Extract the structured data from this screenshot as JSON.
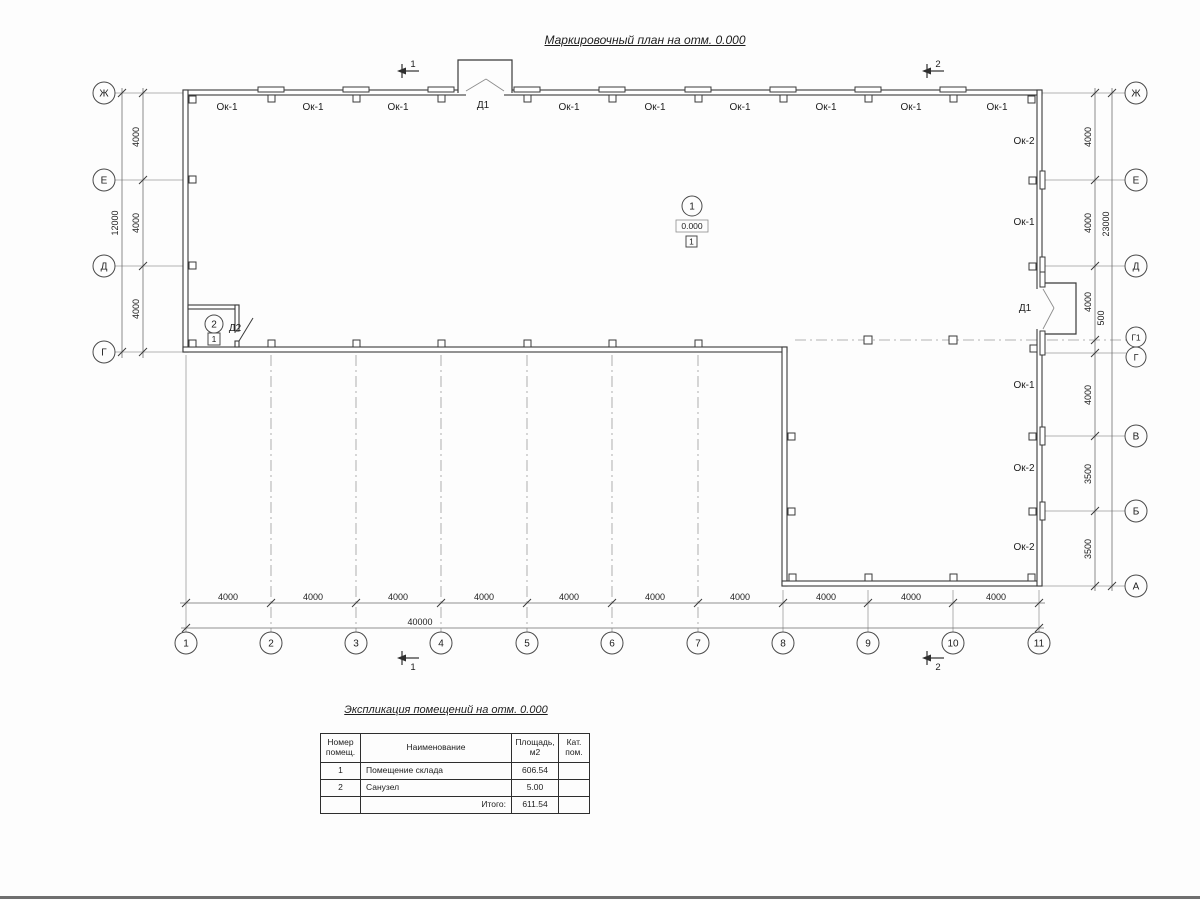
{
  "page": {
    "title": "Маркировочный план на отм. 0.000"
  },
  "plan": {
    "axes": {
      "left": [
        "Ж",
        "Е",
        "Д",
        "Г"
      ],
      "right": [
        "Ж",
        "Е",
        "Д",
        "Г1",
        "Г",
        "В",
        "Б",
        "А"
      ],
      "bottom": [
        "1",
        "2",
        "3",
        "4",
        "5",
        "6",
        "7",
        "8",
        "9",
        "10",
        "11"
      ]
    },
    "dimensions": {
      "left_segments": [
        "4000",
        "4000",
        "4000"
      ],
      "left_total": "12000",
      "right_segments": [
        "4000",
        "4000",
        "4000",
        "500",
        "4000",
        "3500",
        "3500"
      ],
      "right_total": "23000",
      "bottom_segments": [
        "4000",
        "4000",
        "4000",
        "4000",
        "4000",
        "4000",
        "4000",
        "4000",
        "4000",
        "4000"
      ],
      "bottom_total": "40000"
    },
    "windows": {
      "top": [
        "Ок-1",
        "Ок-1",
        "Ок-1",
        "Ок-1",
        "Ок-1",
        "Ок-1",
        "Ок-1",
        "Ок-1",
        "Ок-1"
      ],
      "right": [
        "Ок-2",
        "Ок-1",
        "Ок-1",
        "Ок-2",
        "Ок-2"
      ]
    },
    "doors": {
      "top": "Д1",
      "right": "Д1",
      "wc": "Д2"
    },
    "rooms": {
      "storage": {
        "number": "1",
        "level": "0.000",
        "category": "1"
      },
      "wc": {
        "number": "2",
        "category": "1"
      }
    },
    "sections": {
      "s1": "1",
      "s2": "2"
    }
  },
  "table": {
    "title": "Экспликация помещений на отм. 0.000",
    "headers": {
      "number": "Номер помещ.",
      "name": "Наименование",
      "area": "Площадь, м2",
      "cat": "Кат. пом."
    },
    "rows": [
      {
        "number": "1",
        "name": "Помещение склада",
        "area": "606.54",
        "cat": ""
      },
      {
        "number": "2",
        "name": "Санузел",
        "area": "5.00",
        "cat": ""
      }
    ],
    "total_label": "Итого:",
    "total_area": "611.54"
  },
  "colors": {
    "line": "#3a3a3a",
    "thin": "#8d8d8d",
    "bg": "#fdfdfd"
  }
}
